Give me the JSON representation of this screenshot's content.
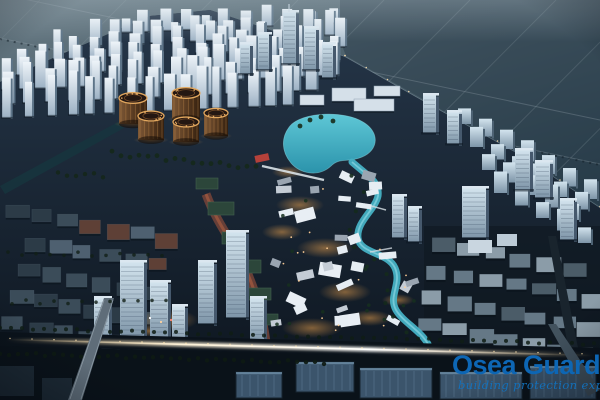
{
  "image": {
    "kind": "aerial architectural rendering",
    "time_of_day": "dusk",
    "description": "Bird's-eye master-plan rendering of a new city district at dusk: rows of white residential towers, five bronze drum-shaped buildings, a turquoise lagoon feeding a winding canal through an illuminated low-rise village, an industrial quarter at lower left, a business park at lower right, farm fields stretching behind, and a brightly lit highway running across the bottom."
  },
  "watermark": {
    "title": "Osea Guard",
    "tagline": "building protection expert",
    "title_color": "#0d66b4",
    "tagline_color": "#1173c1"
  },
  "palette": {
    "field_light": "#687a84",
    "field_dark": "#2e4450",
    "city_base_top": "#26374a",
    "city_base_bottom": "#0c141d",
    "tower_face": "#eef4f9",
    "tower_shade": "#5d7488",
    "glass_face": "#d3e4ee",
    "drum_body": "#7d5836",
    "drum_rim_glow": "#e2a75e",
    "lagoon_water": "#46b1c4",
    "warm_glow": "#f5a84f",
    "road_light": "#fff3d8",
    "roof_brown": "#5e4036",
    "roof_green": "#2c463a",
    "warehouse_blue": "#3b546b"
  }
}
